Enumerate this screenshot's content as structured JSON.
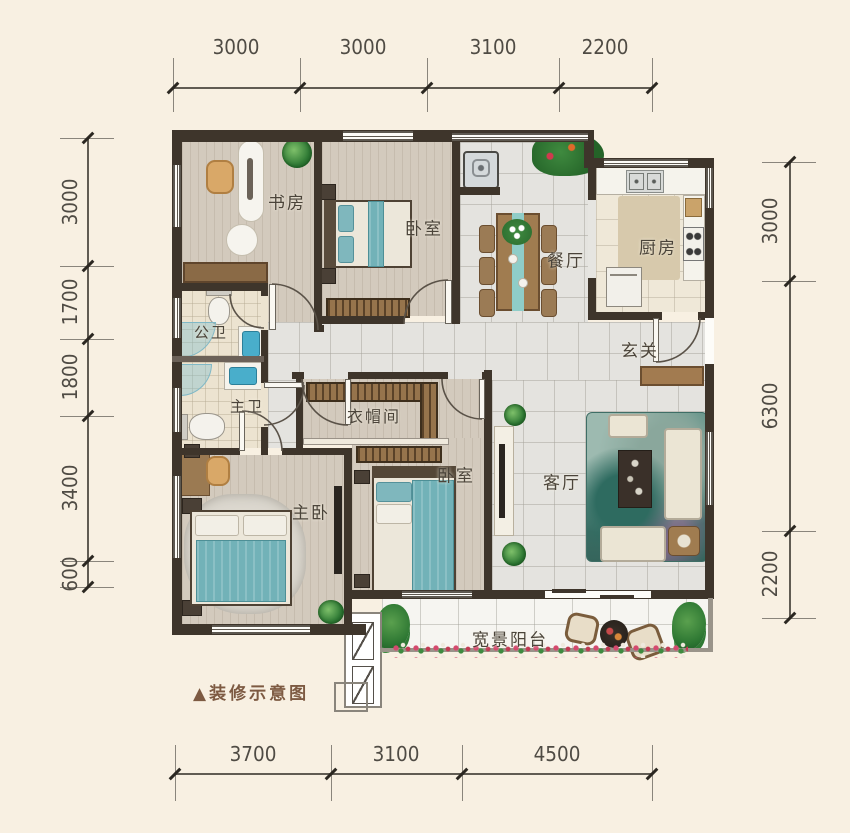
{
  "caption": {
    "text": "▲装修示意图"
  },
  "rooms": {
    "study": {
      "label": "书房"
    },
    "bedroom_top": {
      "label": "卧室"
    },
    "dining": {
      "label": "餐厅"
    },
    "kitchen": {
      "label": "厨房"
    },
    "guest_bath": {
      "label": "公卫"
    },
    "master_bath": {
      "label": "主卫"
    },
    "closet": {
      "label": "衣帽间"
    },
    "entry": {
      "label": "玄关"
    },
    "bedroom_mid": {
      "label": "卧室"
    },
    "master": {
      "label": "主卧"
    },
    "living": {
      "label": "客厅"
    },
    "balcony": {
      "label": "宽景阳台"
    }
  },
  "dimensions": {
    "top": [
      "3000",
      "3000",
      "3100",
      "2200"
    ],
    "left": [
      "3000",
      "1700",
      "1800",
      "3400",
      "600"
    ],
    "right": [
      "3000",
      "6300",
      "2200"
    ],
    "bottom": [
      "3700",
      "3100",
      "4500"
    ]
  },
  "colors": {
    "background": "#f8f0e2",
    "wall": "#3e352b",
    "accent_teal": "#72b2b8",
    "wood_furniture": "#96744c",
    "dimension_text": "#4f4b44",
    "caption_brown": "#7d5a42"
  }
}
